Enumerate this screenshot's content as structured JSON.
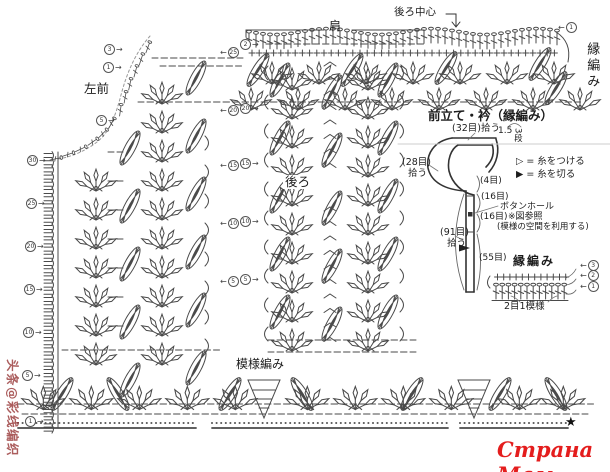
{
  "header": {
    "back_center": "後ろ中心",
    "shoulder": "肩",
    "edge_vertical": "縁編み"
  },
  "pieces": {
    "left_front": "左前",
    "back": "後ろ",
    "pattern": "模様編み"
  },
  "schematic": {
    "title": "前立て・衿（縁編み）",
    "pickup_32": "(32目)拾う",
    "height_cm": "1.5",
    "rows_label": "3段",
    "pickup_28a": "(28目)",
    "pickup_28b": "拾う",
    "count_4": "(4目)",
    "count_16a": "(16目)",
    "buttonhole": "ボタンホール",
    "count_16b": "(16目)",
    "see_ref": "※図参照",
    "use_space_note": "(模様の空間を利用する)",
    "pickup_91a": "(91目)",
    "pickup_91b": "拾う",
    "count_55": "(55目)",
    "legend_attach": "▷ = 糸をつける",
    "legend_cut": "▶ = 糸を切る"
  },
  "edge_chart": {
    "title": "縁編み",
    "repeat": "2目1模様"
  },
  "watermarks": {
    "left_vertical": "头条@彩线编织",
    "site": "Страна Мам"
  },
  "footer": {
    "star": "★"
  },
  "markers": [
    {
      "v": "1",
      "x": 558,
      "y": 22,
      "d": "l"
    },
    {
      "v": "3",
      "x": 104,
      "y": 44,
      "d": "r"
    },
    {
      "v": "1",
      "x": 103,
      "y": 62,
      "d": "r"
    },
    {
      "v": "5",
      "x": 96,
      "y": 115,
      "d": "r"
    },
    {
      "v": "30",
      "x": 27,
      "y": 155,
      "d": "r"
    },
    {
      "v": "25",
      "x": 26,
      "y": 198,
      "d": "r"
    },
    {
      "v": "20",
      "x": 25,
      "y": 241,
      "d": "r"
    },
    {
      "v": "15",
      "x": 24,
      "y": 284,
      "d": "r"
    },
    {
      "v": "10",
      "x": 23,
      "y": 327,
      "d": "r"
    },
    {
      "v": "5",
      "x": 22,
      "y": 370,
      "d": "r"
    },
    {
      "v": "1",
      "x": 25,
      "y": 416,
      "d": "r"
    },
    {
      "v": "25",
      "x": 220,
      "y": 47,
      "d": "l"
    },
    {
      "v": "20",
      "x": 220,
      "y": 105,
      "d": "l"
    },
    {
      "v": "15",
      "x": 220,
      "y": 160,
      "d": "l"
    },
    {
      "v": "10",
      "x": 220,
      "y": 218,
      "d": "l"
    },
    {
      "v": "5",
      "x": 220,
      "y": 276,
      "d": "l"
    },
    {
      "v": "2",
      "x": 240,
      "y": 39,
      "d": "r"
    },
    {
      "v": "20",
      "x": 240,
      "y": 103,
      "d": "r"
    },
    {
      "v": "15",
      "x": 240,
      "y": 158,
      "d": "r"
    },
    {
      "v": "10",
      "x": 240,
      "y": 216,
      "d": "r"
    },
    {
      "v": "5",
      "x": 240,
      "y": 274,
      "d": "r"
    },
    {
      "v": "3",
      "x": 580,
      "y": 260,
      "d": "l"
    },
    {
      "v": "2",
      "x": 580,
      "y": 270,
      "d": "l"
    },
    {
      "v": "1",
      "x": 580,
      "y": 281,
      "d": "l"
    }
  ]
}
